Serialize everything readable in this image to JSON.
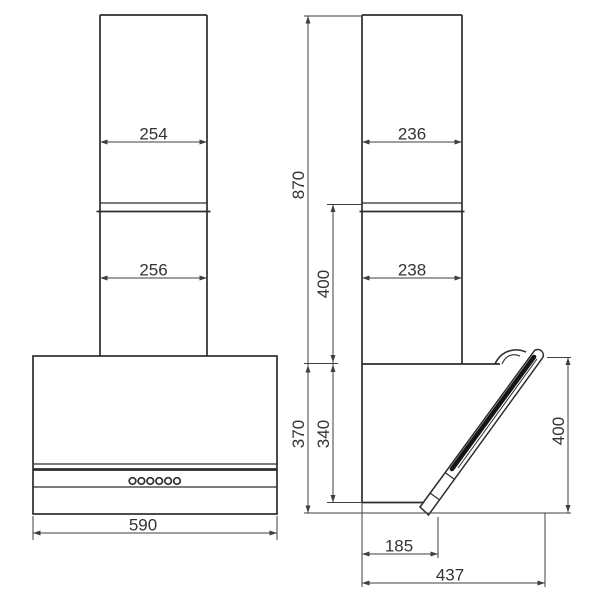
{
  "diagram": {
    "type": "range-hood-dimension-drawing",
    "views": [
      "front-view",
      "side-view"
    ],
    "background_color": "#ffffff",
    "line_color": "#2d2d2d",
    "dimension_line_color": "#3f3f3f",
    "text_color": "#333333",
    "units": "mm"
  },
  "front_view": {
    "control_button_count": 6
  },
  "dims": {
    "front_chimney_upper_width": "254",
    "front_chimney_lower_width": "256",
    "front_total_width": "590",
    "side_chimney_upper_depth": "236",
    "side_chimney_lower_depth": "238",
    "total_height": "870",
    "chimney_lower_section_height": "400",
    "body_front_height": "370",
    "body_back_height": "340",
    "glass_panel_height": "400",
    "body_bottom_depth": "185",
    "total_depth_open": "437"
  }
}
